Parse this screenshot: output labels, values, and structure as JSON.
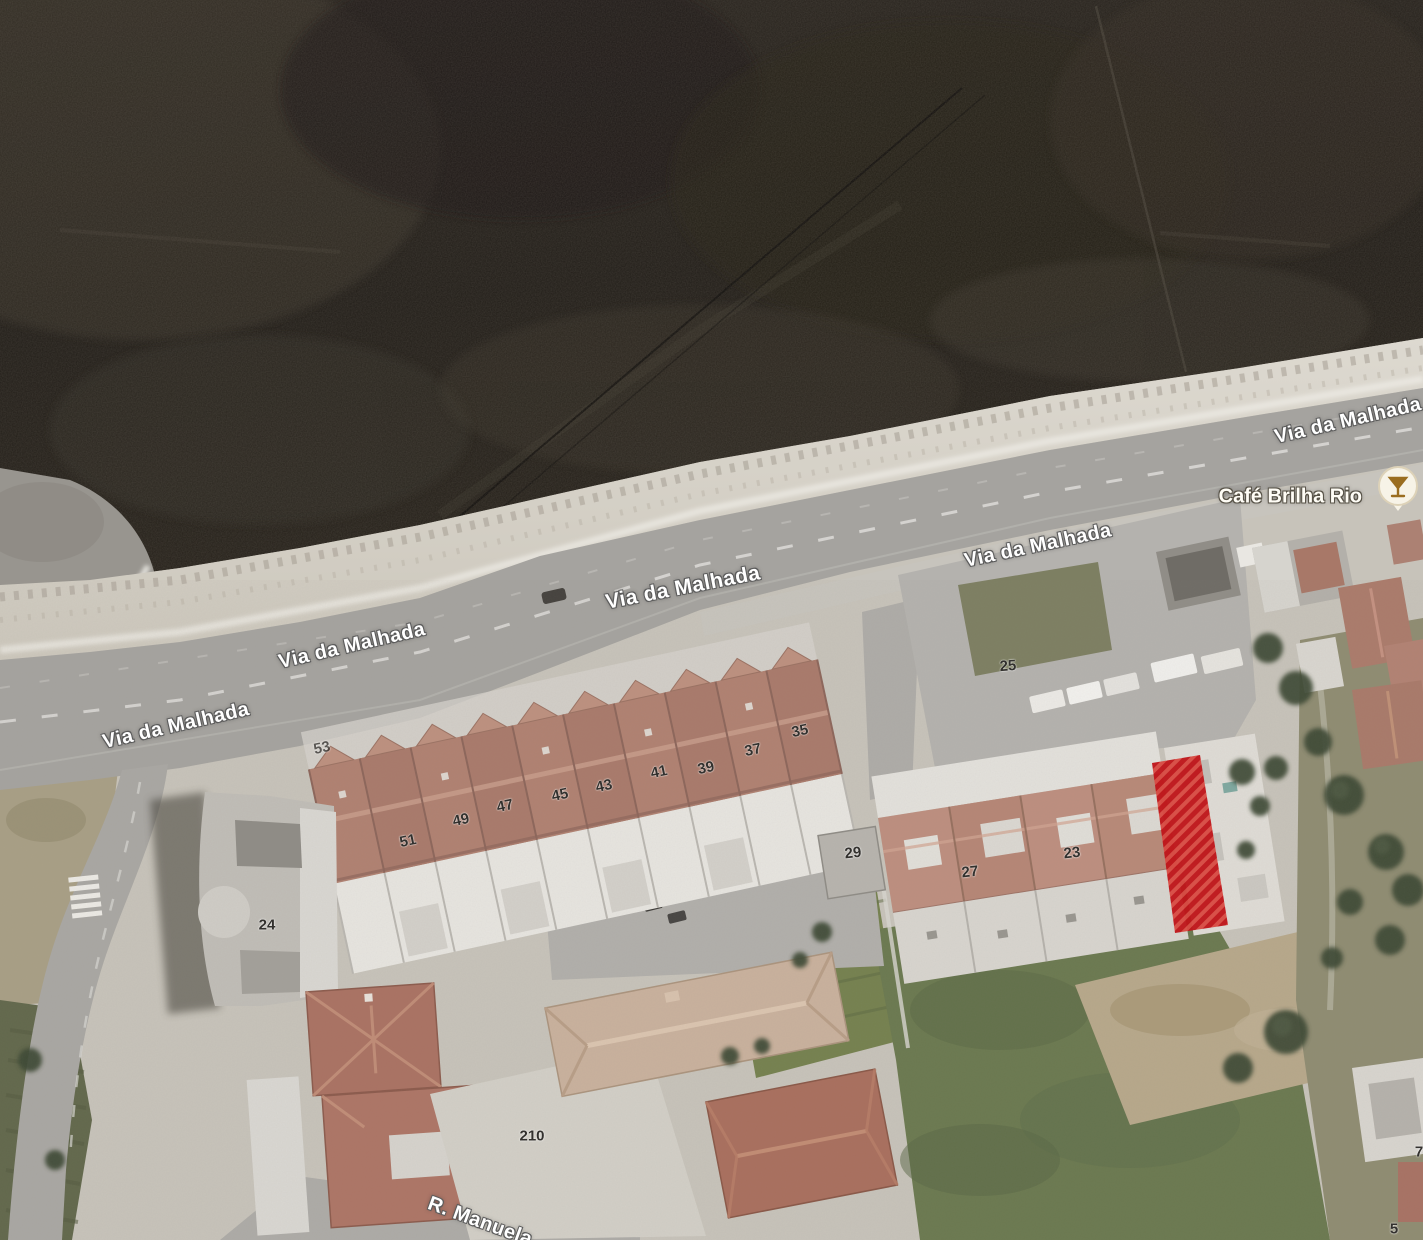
{
  "map": {
    "type": "satellite-imagery",
    "street_labels": [
      {
        "text": "Via da Malhada",
        "x": 176,
        "y": 726,
        "rot": -13,
        "size": 20
      },
      {
        "text": "Via da Malhada",
        "x": 352,
        "y": 646,
        "rot": -13,
        "size": 20
      },
      {
        "text": "Via da Malhada",
        "x": 683,
        "y": 588,
        "rot": -11,
        "size": 21
      },
      {
        "text": "Via da Malhada",
        "x": 1038,
        "y": 546,
        "rot": -12,
        "size": 20
      },
      {
        "text": "Via da Malhada",
        "x": 1348,
        "y": 421,
        "rot": -13,
        "size": 20
      },
      {
        "text": "R. Manuela",
        "x": 480,
        "y": 1222,
        "rot": 20,
        "size": 20
      }
    ],
    "poi": {
      "label": "Café Brilha Rio",
      "icon": "drink-icon",
      "icon_x": 1398,
      "icon_y": 494,
      "label_x": 1362,
      "label_y": 497
    },
    "house_numbers": [
      {
        "text": "53",
        "x": 322,
        "y": 748,
        "rot": -12,
        "opacity": 0.75
      },
      {
        "text": "51",
        "x": 408,
        "y": 841,
        "rot": -12
      },
      {
        "text": "49",
        "x": 461,
        "y": 820,
        "rot": -12
      },
      {
        "text": "47",
        "x": 505,
        "y": 806,
        "rot": -12
      },
      {
        "text": "45",
        "x": 560,
        "y": 795,
        "rot": -12
      },
      {
        "text": "43",
        "x": 604,
        "y": 786,
        "rot": -12
      },
      {
        "text": "41",
        "x": 659,
        "y": 772,
        "rot": -12
      },
      {
        "text": "39",
        "x": 706,
        "y": 768,
        "rot": -12
      },
      {
        "text": "37",
        "x": 753,
        "y": 750,
        "rot": -12
      },
      {
        "text": "35",
        "x": 800,
        "y": 731,
        "rot": -12
      },
      {
        "text": "25",
        "x": 1008,
        "y": 666,
        "rot": -4
      },
      {
        "text": "29",
        "x": 853,
        "y": 853,
        "rot": -6
      },
      {
        "text": "27",
        "x": 970,
        "y": 872,
        "rot": -6
      },
      {
        "text": "23",
        "x": 1072,
        "y": 853,
        "rot": -6
      },
      {
        "text": "24",
        "x": 267,
        "y": 925,
        "rot": 0
      },
      {
        "text": "210",
        "x": 532,
        "y": 1136,
        "rot": 0
      },
      {
        "text": "7",
        "x": 1419,
        "y": 1152,
        "rot": 0
      },
      {
        "text": "5",
        "x": 1394,
        "y": 1229,
        "rot": 0
      }
    ],
    "highlight": {
      "color": "#bf1419",
      "stripe_color": "#d84a42",
      "points": "1152,763 1200,755 1228,925 1175,933"
    },
    "colors": {
      "street_label_text": "#ffffff",
      "house_number_text": "#33312e",
      "poi_icon_glyph": "#9a6d20"
    }
  }
}
